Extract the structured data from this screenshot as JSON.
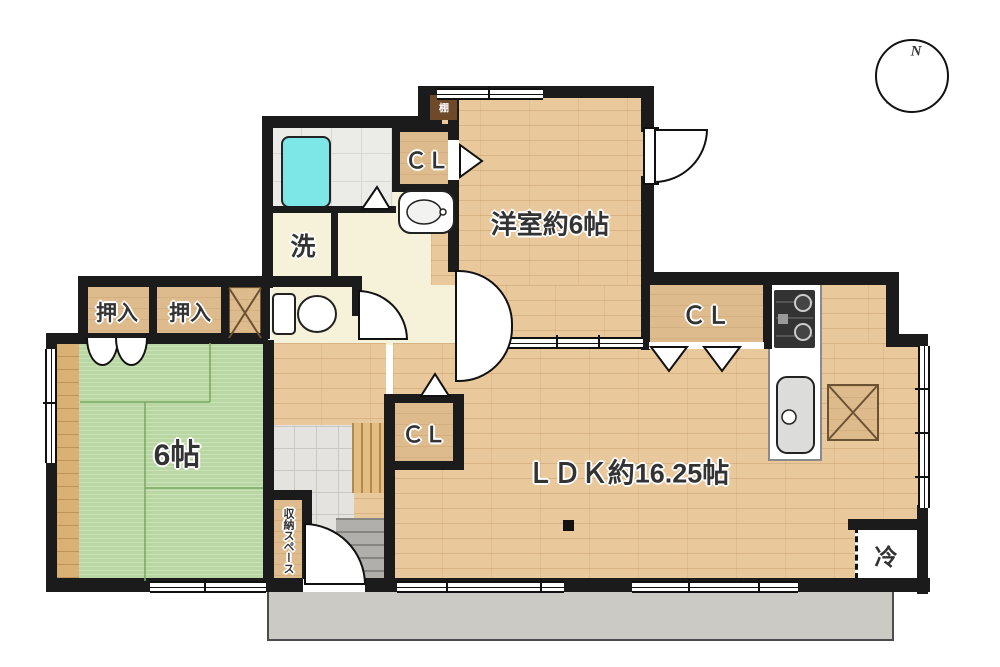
{
  "labels": {
    "yoshitsu": "洋室約6帖",
    "ldk": "ＬＤＫ約16.25帖",
    "washitsu": "6帖",
    "oshiire_left": "押入",
    "oshiire_right": "押入",
    "cl_yoshitsu": "ＣＬ",
    "cl_kitchen": "ＣＬ",
    "cl_genkan": "ＣＬ",
    "laundry": "洗",
    "fridge": "冷",
    "storage_space": "収納スペース",
    "shelf": "棚",
    "compass_north": "N"
  },
  "colors": {
    "wall": "#1b1b1b",
    "wood_floor": "#e9c89b",
    "closet_wood": "#debb8d",
    "tatami": "#b9d7a2",
    "tatami_line": "#79a763",
    "cream_floor": "#f6f1d9",
    "bath_tile": "#ebebe7",
    "bathtub": "#7de6e7",
    "genkan_tile": "#e4e3df",
    "porch_concrete": "#cbcac5",
    "step_gray": "#b0afab",
    "shelf_brown": "#6e4a2a",
    "label_text": "#333333"
  }
}
